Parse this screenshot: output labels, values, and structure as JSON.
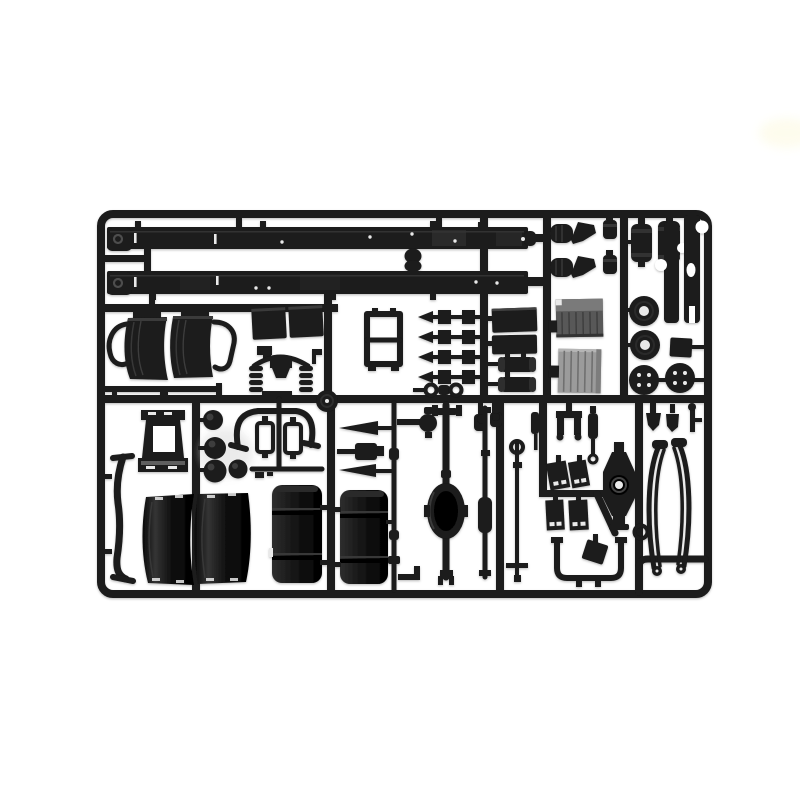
{
  "scene": {
    "type": "product photograph",
    "description": "Black injection-moulded model kit sprue (parts tree) of truck chassis components on a white background",
    "background": "#ffffff"
  },
  "colors": {
    "background": "#ffffff",
    "plastic": "#1a1a1a",
    "plasticDeep": "#0c0c0c",
    "sheen": "#3a3a3a",
    "greyDark": "#5f5f5f",
    "greyLight": "#9b9b9b",
    "slot": "#e9e9e9",
    "smudge": "#fdfbe8"
  },
  "parts": {
    "frame": {
      "label": "Rectangular sprue runner frame with internal runner bars"
    },
    "rail_upper": {
      "label": "Truck chassis side rail (upper)"
    },
    "rail_lower": {
      "label": "Truck chassis side rail (lower)"
    },
    "wheel_arch_assembly": {
      "label": "Front wheel-arch halves with wire mounting frame"
    },
    "step_rod": {
      "label": "Thin side-step rod with end tabs"
    },
    "battery_lids": {
      "label": "Battery box panels"
    },
    "axle_spring_assembly": {
      "label": "Front axle with coil springs"
    },
    "corner_bracket": {
      "label": "Small L-shaped bracket"
    },
    "pulley_disc": {
      "label": "Pulley disc"
    },
    "radiator_frame": {
      "label": "Radiator mounting frame"
    },
    "manifold_rods": {
      "label": "Four exhaust rods with square flanges and pointed tips"
    },
    "link_rings": {
      "label": "Stabilizer link with ring ends"
    },
    "equipment_panels": {
      "label": "Equipment box panels"
    },
    "mufflers": {
      "label": "Two muffler cylinders"
    },
    "grille_upper": {
      "label": "Grille panel, dark grey"
    },
    "grille_lower": {
      "label": "Grille panel, light grey"
    },
    "engine_mounts": {
      "label": "Engine mount brackets with ribbed bushings"
    },
    "small_cylinders": {
      "label": "Small ribbed cylinders"
    },
    "air_tanks": {
      "label": "Two air reservoir tanks"
    },
    "flat_links": {
      "label": "Flat link plates with round cut-outs"
    },
    "hub_discs": {
      "label": "Two hub discs with centre holes"
    },
    "drum_discs": {
      "label": "Two brake-drum discs with four holes"
    },
    "square_plate": {
      "label": "Square mounting plate"
    },
    "cab_tower": {
      "label": "Cab tilt support tower with open window"
    },
    "spheres": {
      "label": "Four spherical air filters"
    },
    "exhaust_arch": {
      "label": "Exhaust arch with twin canisters"
    },
    "torque_rods": {
      "label": "Torque rods and steering box"
    },
    "long_rod": {
      "label": "Long coupling rod with collars"
    },
    "knuckle": {
      "label": "Steering knuckle on stub axle"
    },
    "fender_halves": {
      "label": "Two large rear fender halves"
    },
    "fuel_tanks": {
      "label": "Two large fuel tanks with strap lines"
    },
    "side_bracket": {
      "label": "Long curved side bracket"
    },
    "rear_axle": {
      "label": "Rear axle shaft with differential housing"
    },
    "spring_bar": {
      "label": "Leaf-spring bar with centre sleeve"
    },
    "drag_link": {
      "label": "Drag link rod with eye end"
    },
    "shackle_yoke": {
      "label": "Spring shackle yoke"
    },
    "shocks": {
      "label": "Shock absorbers"
    },
    "mud_flaps": {
      "label": "Four mud flaps with slotted bottoms"
    },
    "axle_plate": {
      "label": "Axle housing plate with centre boss"
    },
    "u_tube": {
      "label": "U-shaped bumper tube"
    },
    "small_plate": {
      "label": "Small tilted mounting plate"
    },
    "fork_brackets": {
      "label": "Small fork brackets and pin"
    },
    "leaf_springs": {
      "label": "Two curved leaf springs with eye ends"
    },
    "smudge": {
      "label": "Faint yellow smudge on white backdrop"
    }
  }
}
